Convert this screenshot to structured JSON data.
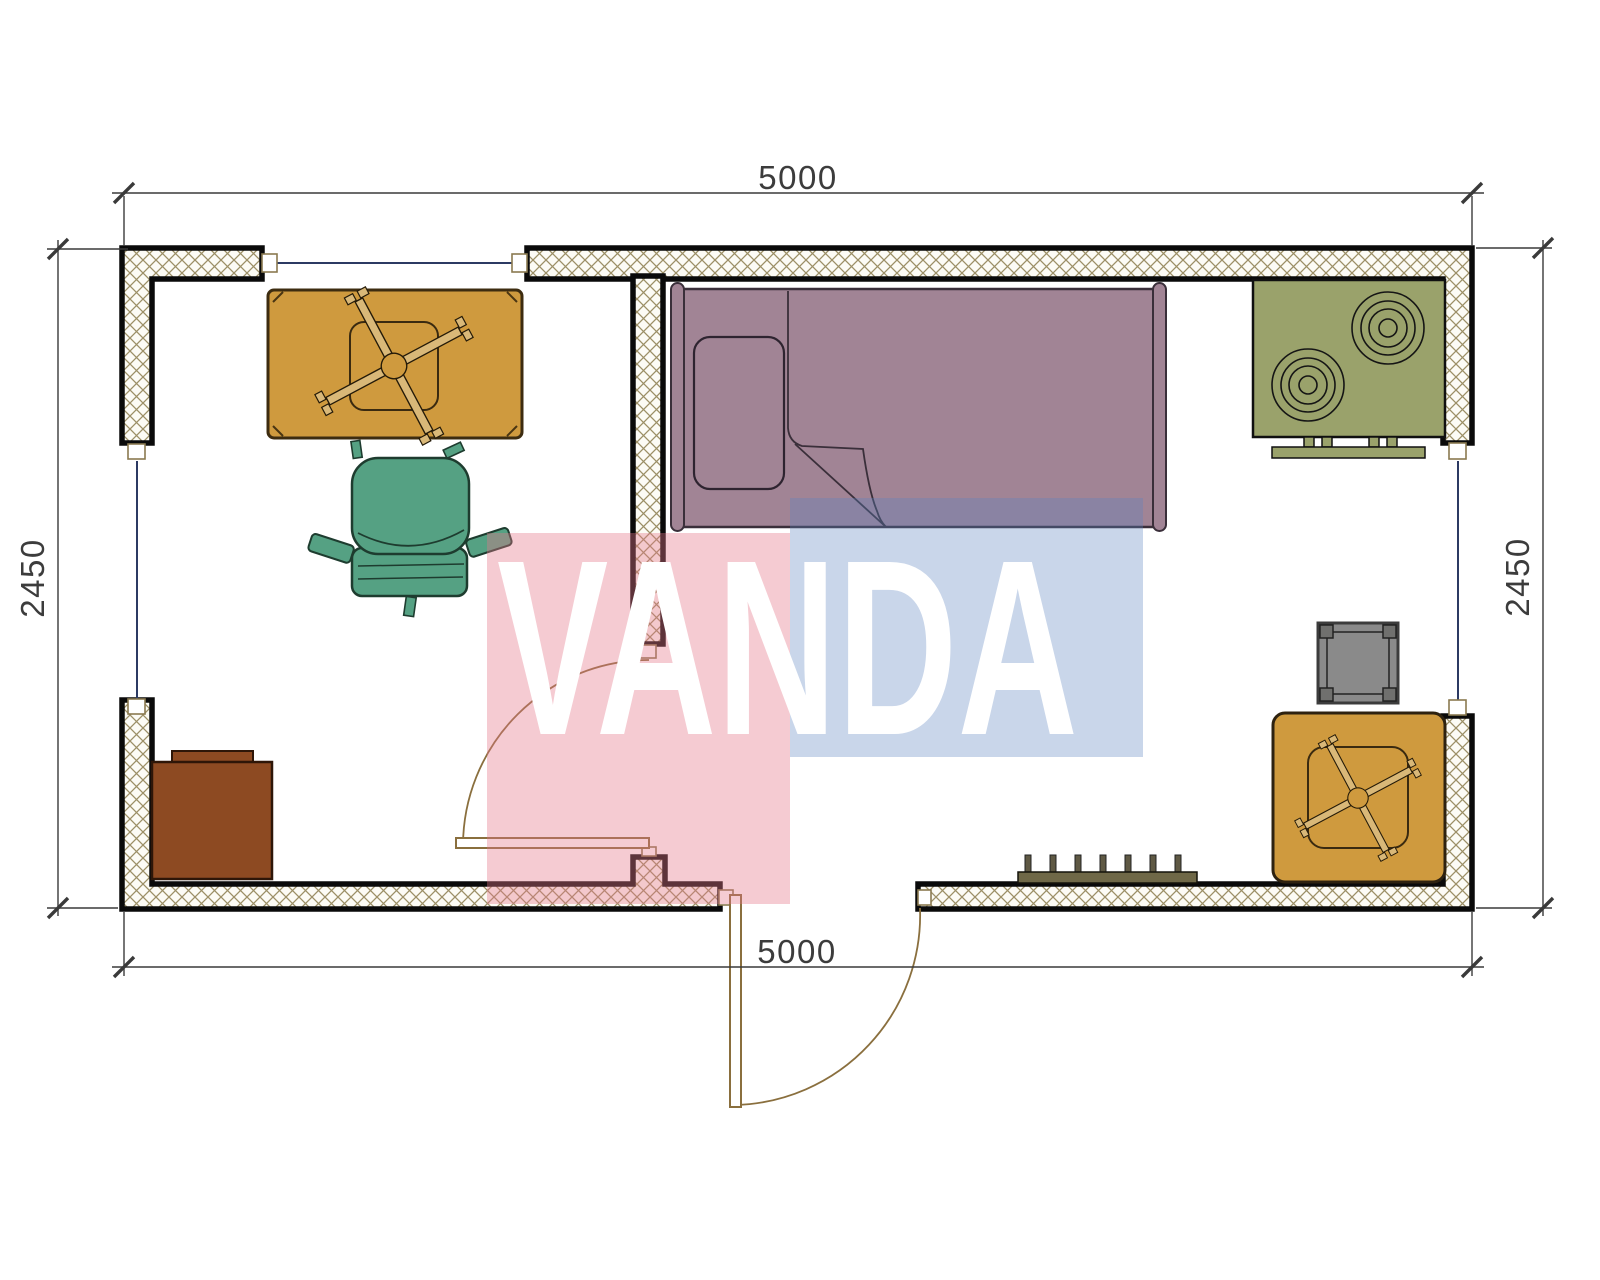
{
  "plan": {
    "kind": "floor-plan",
    "background": "#ffffff"
  },
  "dimensions": {
    "top": "5000",
    "bottom": "5000",
    "left": "2450",
    "right": "2450"
  },
  "watermark": {
    "text": "VANDA",
    "text_color": "#ffffff",
    "pink": "rgba(228,118,138,0.38)",
    "blue": "rgba(90,130,190,0.33)"
  },
  "colors": {
    "wall_outline": "#0a0a0a",
    "wall_hatch_line": "#9c8f66",
    "wall_fill": "#fcfbf5",
    "window_line": "#2c3a63",
    "door_line": "#8a6f3e",
    "dim_line": "#3a3a3a",
    "table_wood": "#cf9a3e",
    "table_base": "#d9b878",
    "chair_green": "#55a183",
    "bed_mauve": "#a18495",
    "stove_olive": "#9aa26b",
    "cabinet_brown": "#8d4a22",
    "stool_gray": "#8a8a8a",
    "stool_corner": "#70706e",
    "radiator_olive": "#6f6847",
    "radiator_teeth": "#5f5944"
  },
  "furniture": {
    "table_top_left": "pedestal-table",
    "chair": "office-armchair",
    "bed": "single-bed",
    "stove": "two-burner-stove",
    "cabinet": "cabinet",
    "stool": "square-stool",
    "table_bottom_right": "pedestal-table",
    "radiator": "radiator"
  }
}
